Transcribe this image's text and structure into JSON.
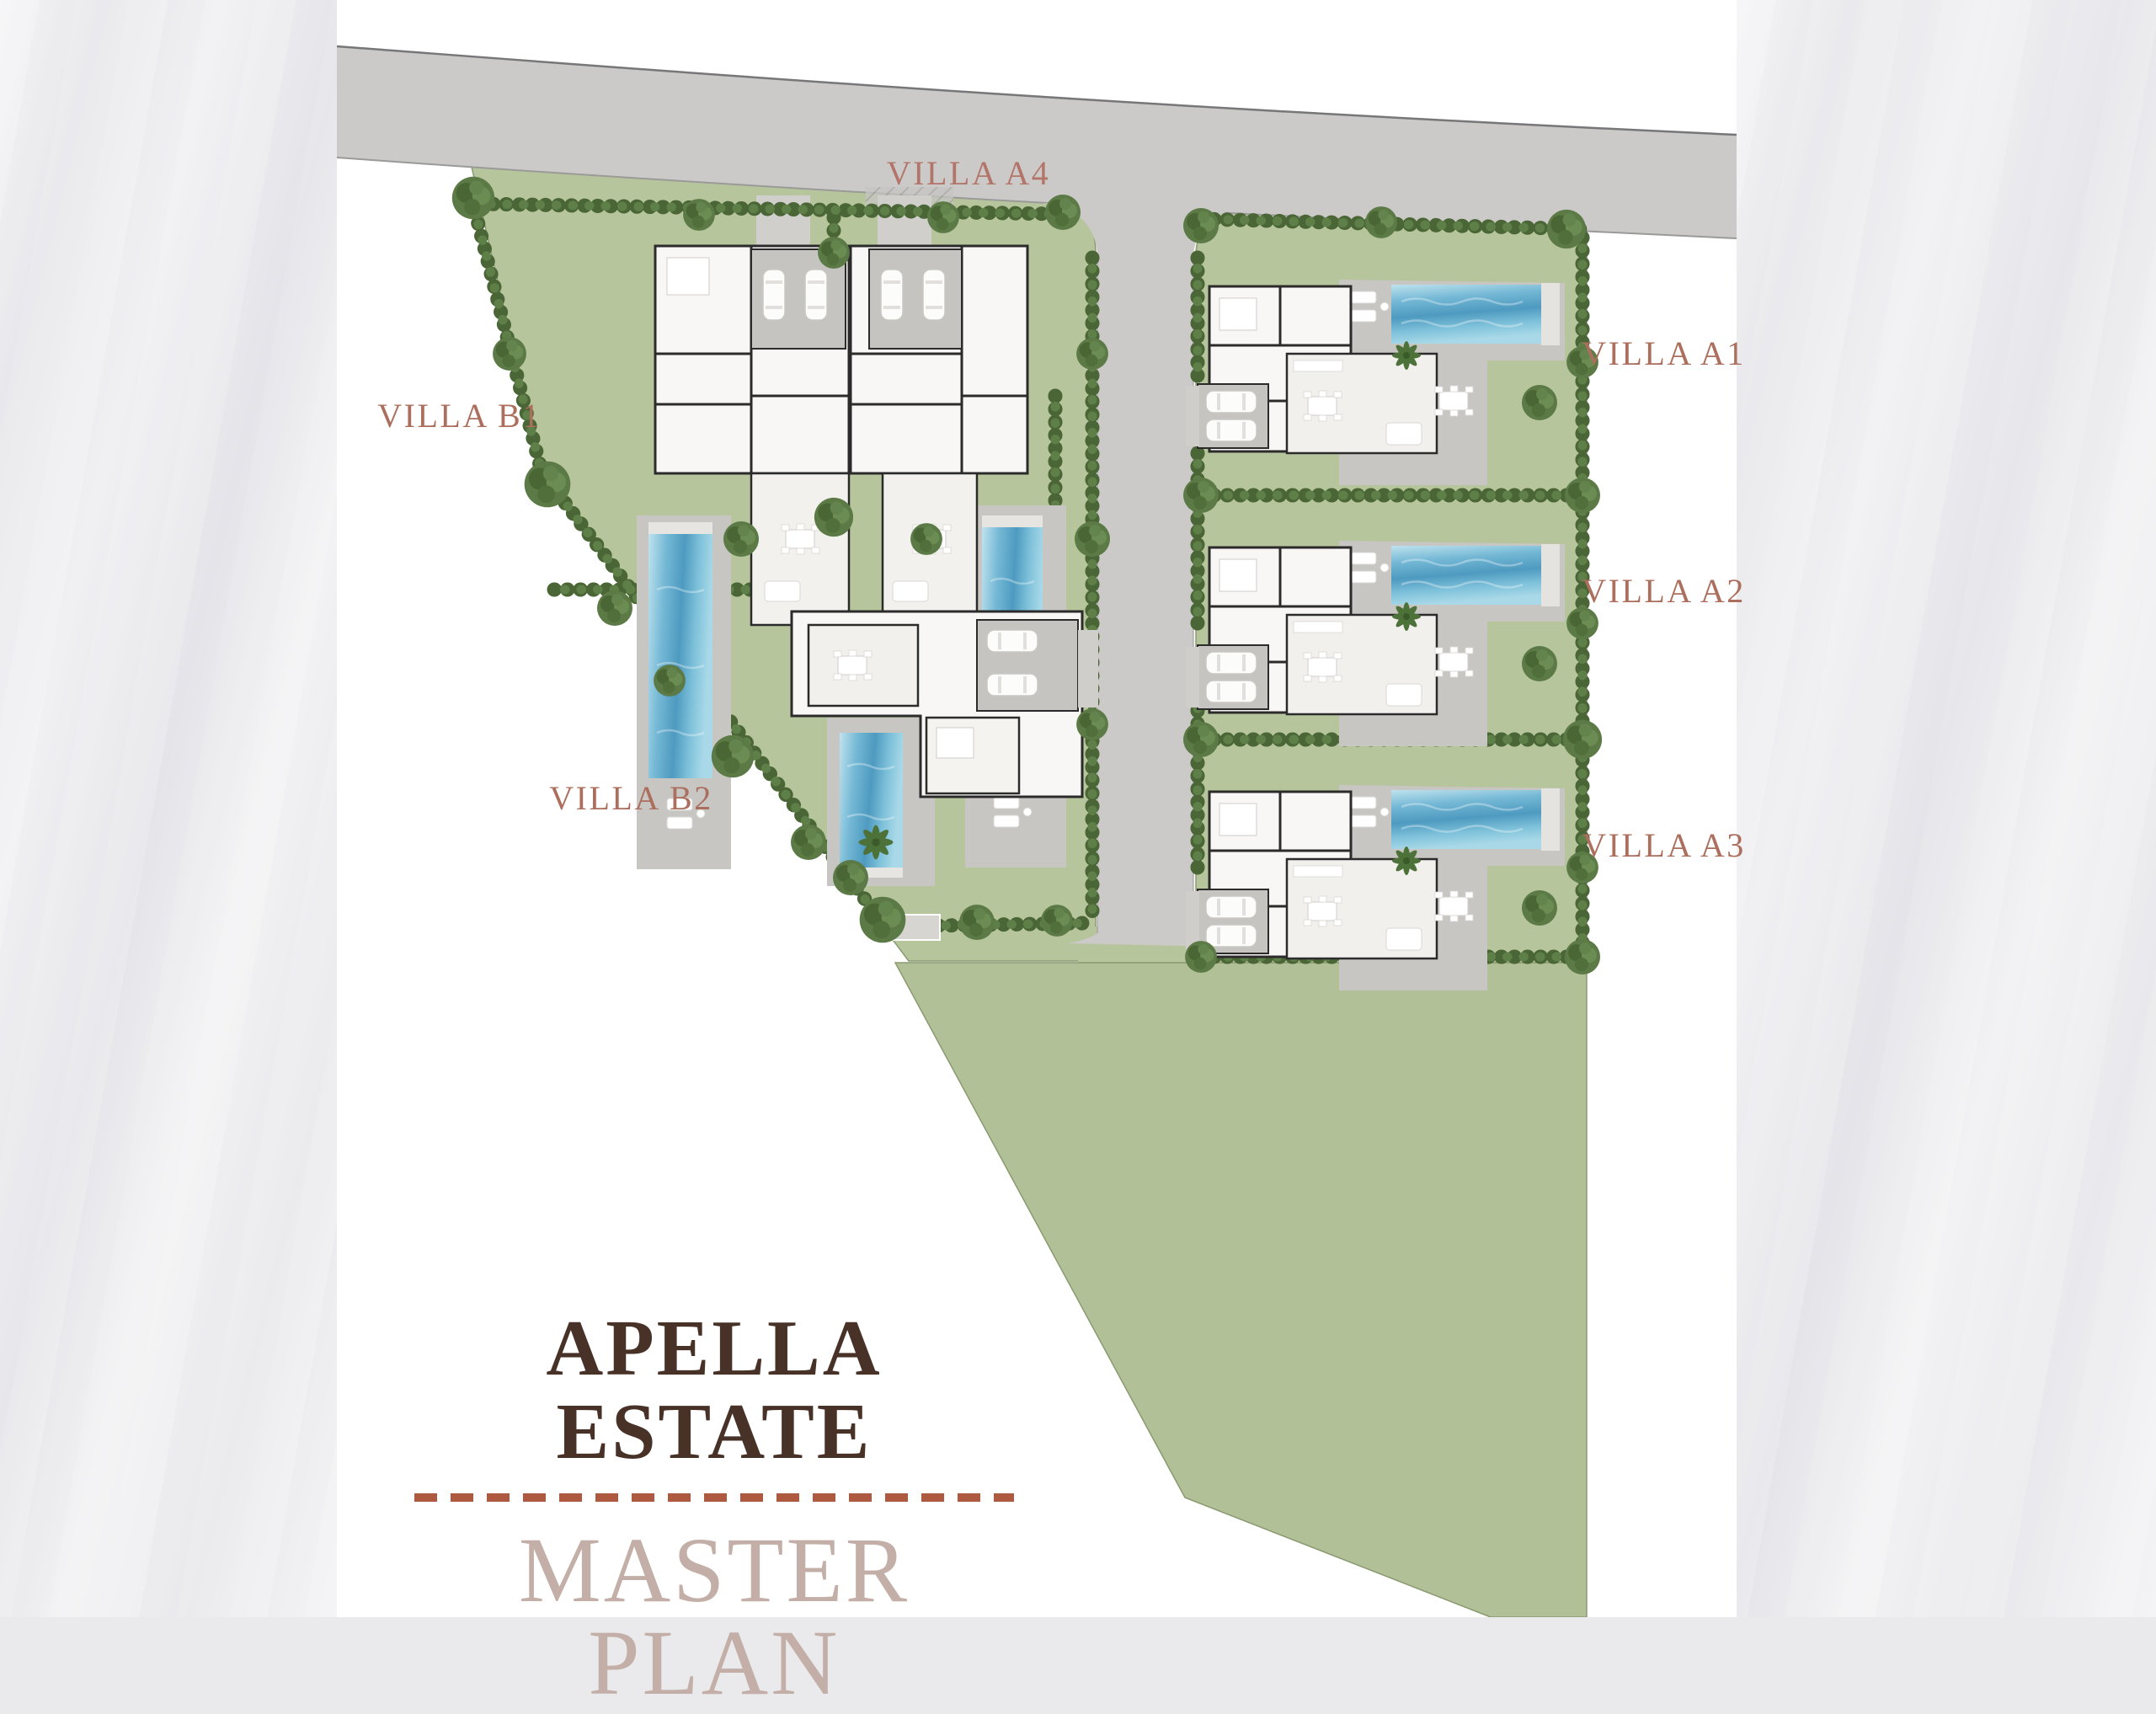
{
  "title_block": {
    "title": "APELLA ESTATE",
    "subtitle": "MASTER PLAN"
  },
  "villa_labels": {
    "a4": "VILLA A4",
    "b1": "VILLA B1",
    "b2": "VILLA B2",
    "a1": "VILLA A1",
    "a2": "VILLA A2",
    "a3": "VILLA A3"
  },
  "plan_features": {
    "road": "access road along top",
    "street": "central private street",
    "pools": 6,
    "villas": 6,
    "lawn_areas": "landscaped plots and large south lawn wedge"
  },
  "palette": {
    "page": "#ffffff",
    "marble": "#eaeaed",
    "road": "#cbcac8",
    "road_edge": "#77777a",
    "lawn": "#b7c59d",
    "hedge": "#4b6636",
    "tree": "#5c7a45",
    "pool_light": "#a9d9e8",
    "pool_dark": "#4e9ac0",
    "deck": "#c7c6c3",
    "building": "#f8f7f5",
    "wall": "#2b2b2b",
    "label_text": "#ac6f5d",
    "title_text": "#483228",
    "subtitle_text": "#c3afa7",
    "divider": "#ad5a41"
  }
}
